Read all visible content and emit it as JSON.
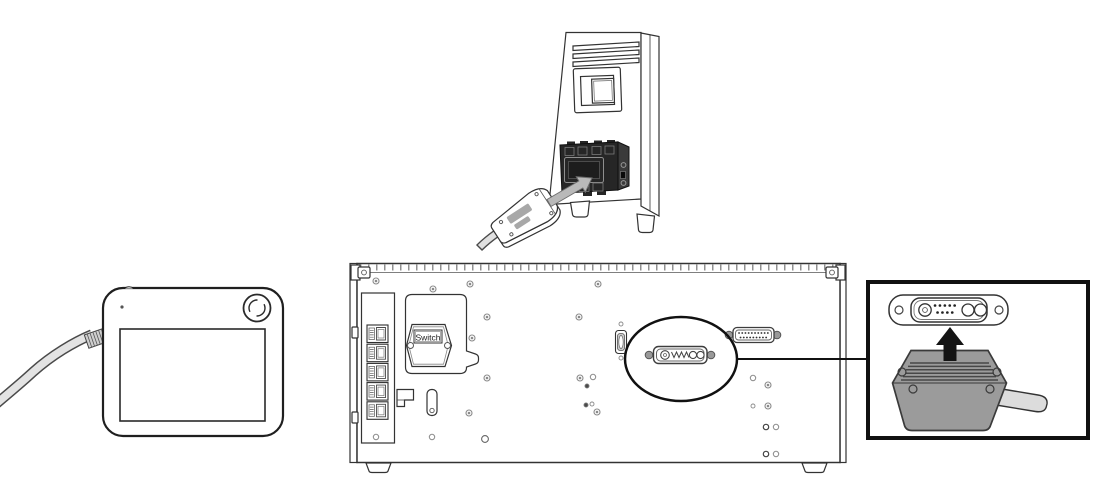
{
  "diagram": {
    "kind": "hardware-connection-illustration",
    "labels": {
      "switch_plate": "Switch"
    },
    "colors": {
      "outline": "#333333",
      "io_block_dark": "#262626",
      "plug_gray": "#9b9b9b",
      "cable_gray": "#e0e0e0",
      "arrow_gray": "#b9b9b9",
      "arrow_black": "#141414",
      "screw_gray": "#8a8a8a",
      "callout_black": "#111111",
      "background": "#ffffff"
    },
    "parts": {
      "controller_tower": "controller-rear-io-block-with-plug",
      "teach_pendant": "pendant-with-estop-and-cable",
      "rear_panel": "controller-rear-panel",
      "ethernet_port_count": 5,
      "highlighted_connector": "dsub-combo-connector",
      "detail_callout": "connector-insertion-detail"
    }
  }
}
